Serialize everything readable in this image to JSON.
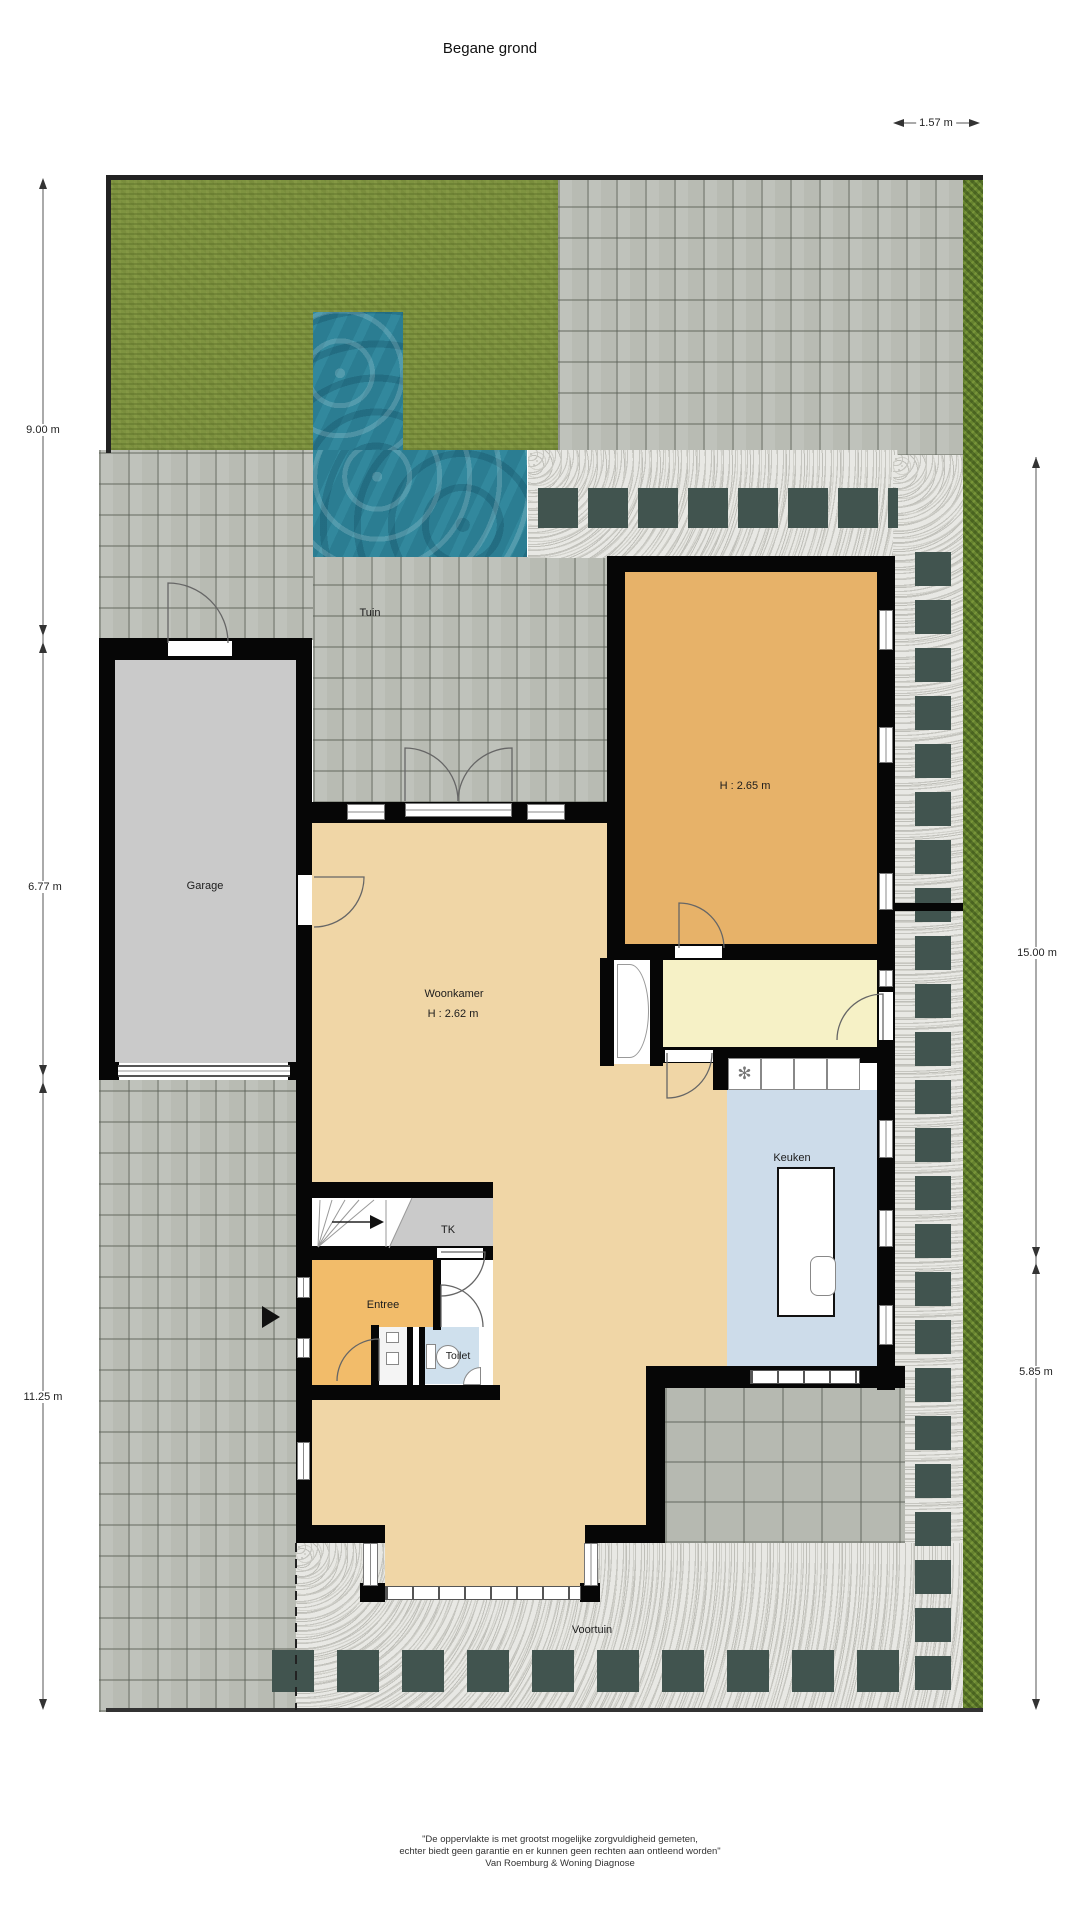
{
  "title": "Begane grond",
  "dimensions": {
    "top": "1.57 m",
    "left_top": "9.00 m",
    "left_mid": "6.77 m",
    "left_bottom": "11.25 m",
    "right_top": "15.00 m",
    "right_bottom": "5.85 m"
  },
  "rooms": {
    "tuin": "Tuin",
    "garage": "Garage",
    "woonkamer": "Woonkamer",
    "woonkamer_height": "H : 2.62 m",
    "back_room_height": "H : 2.65 m",
    "keuken": "Keuken",
    "tk": "TK",
    "entree": "Entree",
    "toilet": "Toilet",
    "voortuin": "Voortuin"
  },
  "footer": {
    "line1": "\"De oppervlakte is met grootst mogelijke zorgvuldigheid gemeten,",
    "line2": "echter biedt geen garantie en er kunnen geen rechten aan ontleend worden\"",
    "line3": "Van Roemburg & Woning Diagnose"
  },
  "colors": {
    "wall": "#060606",
    "grass": "#7e9340",
    "pool": "#2b7d92",
    "paving": "#b8bbb3",
    "gravel": "#e8e8e4",
    "slate_tile": "#41544f",
    "hedge": "#66832f",
    "wood_floor": "#f0d6a6",
    "back_room_floor": "#e7b269",
    "entree_floor": "#f2bc6a",
    "yellow_room_floor": "#f6f1c6",
    "keuken_floor": "#cddcea",
    "toilet_floor": "#cfe0ed",
    "garage_floor": "#cacaca"
  }
}
